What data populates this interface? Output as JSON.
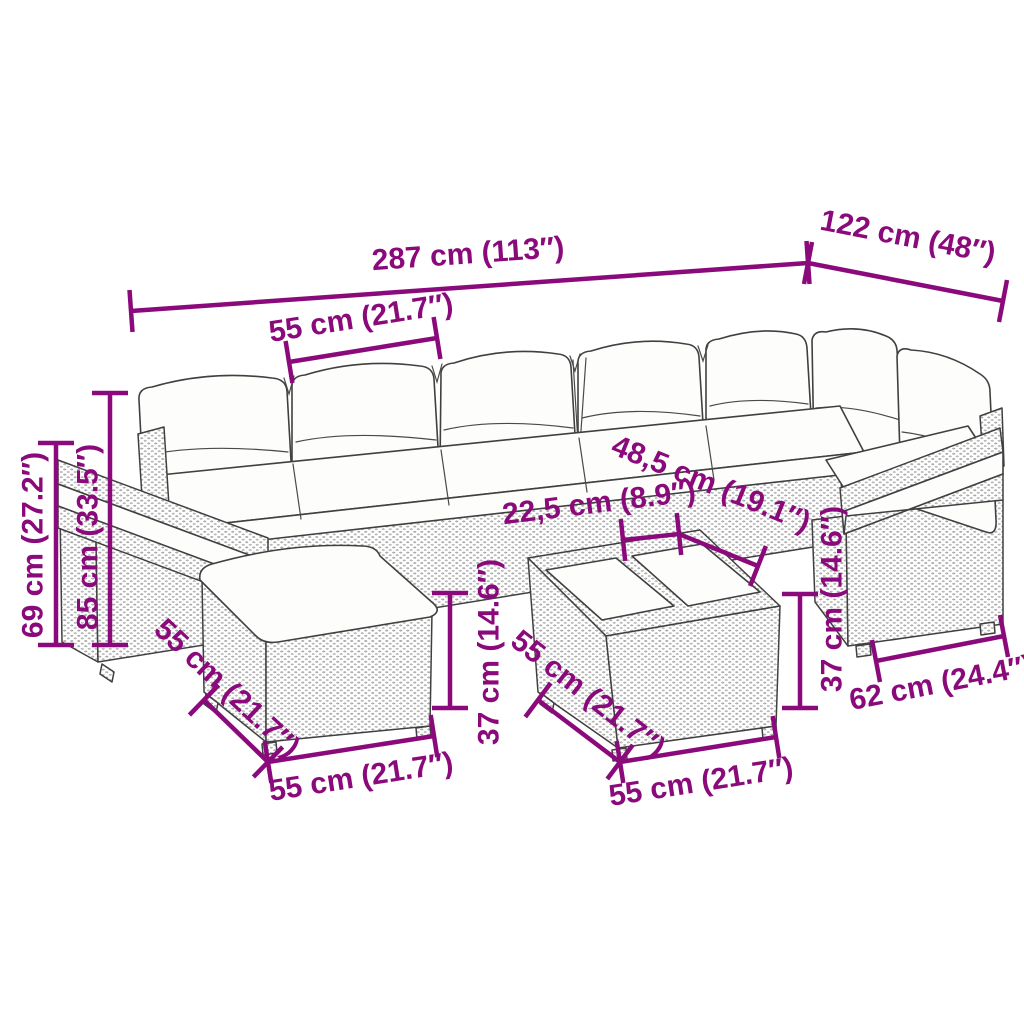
{
  "title": "Garden furniture set dimension diagram",
  "colors": {
    "dimension_annotation": "#8B0A7B",
    "line_art": "#404040",
    "background": "#FFFFFF"
  },
  "illustration": {
    "description": "Black-and-white line drawing of an L-shaped poly rattan garden lounge set with white back and seat cushions, a cushioned ottoman footstool at the front left and a square coffee table with two white top panels at the front center"
  },
  "dimensions": [
    {
      "id": "total-width",
      "label": "287 cm (113″)",
      "placement": "top, full width of sofa"
    },
    {
      "id": "total-depth",
      "label": "122 cm (48″)",
      "placement": "top right, diagonal along right wing"
    },
    {
      "id": "seat-module-width",
      "label": "55 cm (21.7″)",
      "placement": "upper left, over one seat module"
    },
    {
      "id": "armrest-height",
      "label": "69 cm (27.2″)",
      "placement": "far left, vertical"
    },
    {
      "id": "backrest-height",
      "label": "85 cm (33.5″)",
      "placement": "left, vertical"
    },
    {
      "id": "tabletop-segment",
      "label": "22,5 cm (8.9″)",
      "placement": "center, on tabletop"
    },
    {
      "id": "tabletop-diagonal",
      "label": "48,5 cm (19.1″)",
      "placement": "center, on tabletop diagonal"
    },
    {
      "id": "table-height",
      "label": "37 cm (14.6″)",
      "placement": "center, vertical beside table"
    },
    {
      "id": "ottoman-side",
      "label": "55 cm (21.7″)",
      "placement": "lower left, along ottoman side edge"
    },
    {
      "id": "ottoman-front",
      "label": "55 cm (21.7″)",
      "placement": "bottom left, along ottoman front edge"
    },
    {
      "id": "table-side",
      "label": "55 cm (21.7″)",
      "placement": "bottom center, along table side edge"
    },
    {
      "id": "table-front",
      "label": "55 cm (21.7″)",
      "placement": "bottom center, along table front edge"
    },
    {
      "id": "seat-height",
      "label": "37 cm (14.6″)",
      "placement": "right, vertical beside sofa base"
    },
    {
      "id": "seat-depth",
      "label": "62 cm (24.4″)",
      "placement": "bottom right, along wing base"
    }
  ]
}
